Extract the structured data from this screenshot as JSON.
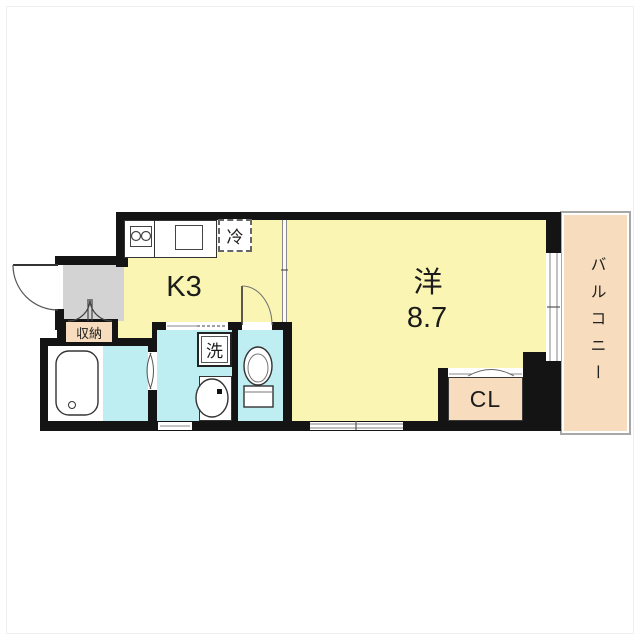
{
  "rooms": {
    "kitchen": {
      "label": "K3"
    },
    "western_room": {
      "label": "洋",
      "size": "8.7"
    },
    "balcony": {
      "label": "バルコニー"
    },
    "closet": {
      "label": "CL"
    },
    "storage": {
      "label": "収納"
    }
  },
  "fixtures": {
    "refrigerator": {
      "label": "冷"
    },
    "washing_machine": {
      "label": "洗"
    }
  },
  "icons": {
    "bathtub": "bathtub-icon",
    "toilet": "toilet-icon",
    "wash_basin": "basin-icon",
    "stove": "stove-burners-icon",
    "kitchen_sink": "sink-icon",
    "entrance_door": "door-swing-icon",
    "storage_doors": "double-door-swing-icon",
    "toilet_door": "door-swing-icon",
    "bath_door": "folding-door-icon",
    "closet_door": "folding-door-icon",
    "window": "sliding-window-icon"
  },
  "colors": {
    "room_fill": "#FAF5B3",
    "wet_area_fill": "#BEEDF2",
    "balcony_fill": "#F8DCBE",
    "closet_fill": "#F8DCBE",
    "entry_fill": "#D3D3D3",
    "wall": "#141414",
    "balcony_border": "#A8A8A8"
  }
}
